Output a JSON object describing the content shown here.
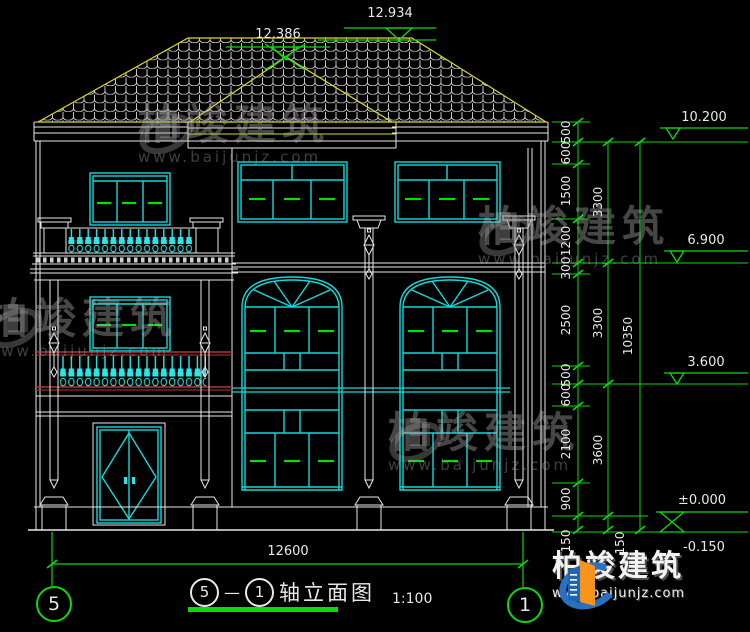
{
  "levels": {
    "main_ridge": "12.934",
    "hip_ridge": "12.386",
    "parapet": "10.200",
    "second_floor": "6.900",
    "first_floor": "3.600",
    "zero": "±0.000",
    "outdoor": "-0.150"
  },
  "dims": {
    "col1": [
      "500",
      "600",
      "1500",
      "1200",
      "300",
      "2500",
      "500",
      "600",
      "2100",
      "900",
      "150"
    ],
    "col2": [
      "3300",
      "3300",
      "3600",
      "150"
    ],
    "col3": [
      "10350"
    ],
    "bottom": "12600"
  },
  "axes": {
    "left": "5",
    "right": "1"
  },
  "title": {
    "axis_from": "5",
    "dash": "—",
    "axis_to": "1",
    "name": "轴立面图",
    "scale": "1:100"
  },
  "watermark": {
    "brand": "柏竣建筑",
    "url": "www.baijunjz.com"
  },
  "logo": {
    "brand": "柏竣建筑",
    "url": "www.baijunjz.com"
  },
  "colors": {
    "line_white": "#e8e8e8",
    "window_cyan": "#12d9d9",
    "roof_yellow": "#d9d927",
    "dim_green": "#0fd60f",
    "open_green": "#00e000",
    "rail_red": "#b03434",
    "logo_blue": "#2a6fc0",
    "logo_orange": "#f7941d"
  }
}
